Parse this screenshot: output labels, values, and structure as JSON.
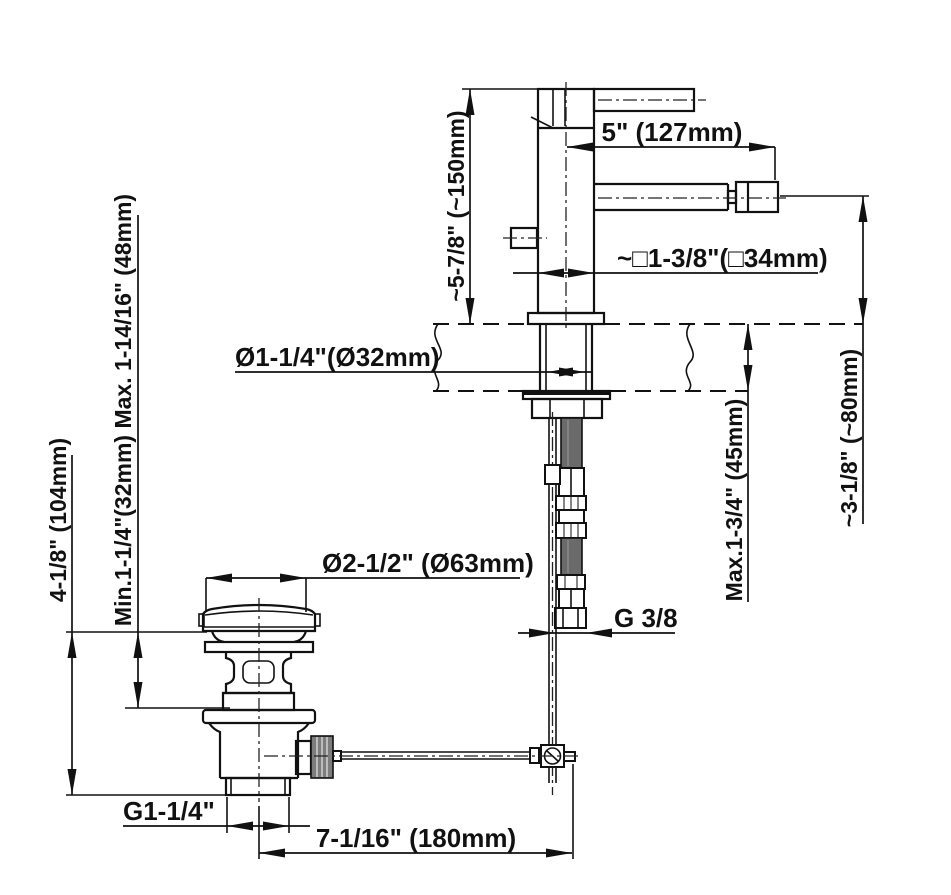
{
  "drawing": {
    "line_color": "#111111",
    "background_color": "#ffffff",
    "dimensions": {
      "faucet_height": "~5-7/8\" (~150mm)",
      "spout_reach": "5\" (127mm)",
      "body_square": "~□1-3/8\"(□34mm)",
      "shank_diameter": "Ø1-1/4\"(Ø32mm)",
      "spout_height_above_deck": "~3-1/8\" (~80mm)",
      "deck_thickness_max": "Max.1-3/4\" (45mm)",
      "drain_deck_range": "Min.1-1/4\"(32mm) Max. 1-14/16\" (48mm)",
      "drain_height": "4-1/8\" (104mm)",
      "drain_cap_diameter": "Ø2-1/2\" (Ø63mm)",
      "supply_thread": "G 3/8",
      "drain_thread": "G1-1/4\"",
      "rod_horizontal_offset": "7-1/16\" (180mm)"
    }
  }
}
